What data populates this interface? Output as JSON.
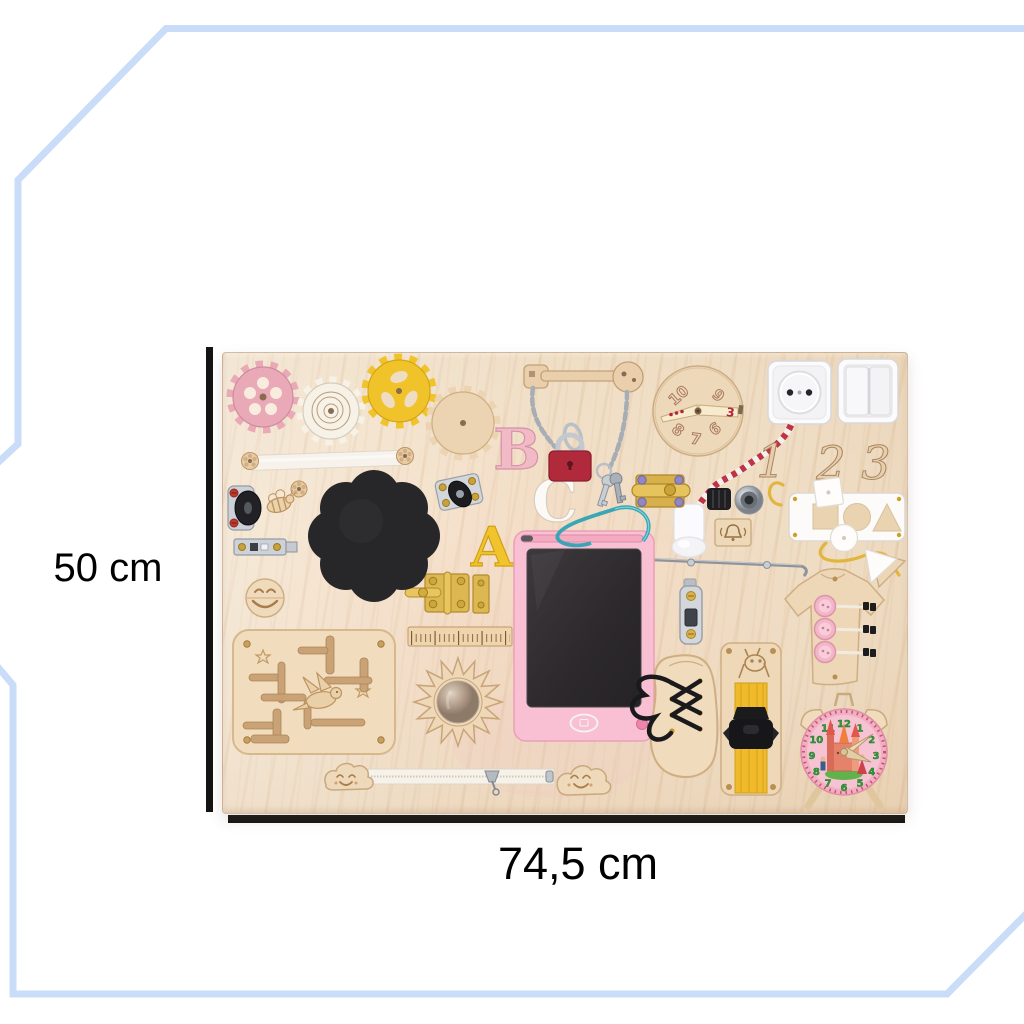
{
  "dimensions": {
    "height_label": "50 cm",
    "width_label": "74,5 cm"
  },
  "letters": {
    "b": "B",
    "c": "C",
    "a": "A"
  },
  "cutout_numbers": {
    "one": "1",
    "two": "2",
    "three": "3"
  },
  "spinner": {
    "labels": [
      "10",
      "9",
      "8",
      "7",
      "6"
    ],
    "pointer_value": "3"
  },
  "clock": {
    "numbers": [
      "12",
      "1",
      "2",
      "3",
      "4",
      "5",
      "6",
      "7",
      "8",
      "9",
      "10",
      "11"
    ]
  },
  "colors": {
    "frame_accent": "#c9dcf8",
    "dimension_line": "#141414",
    "board_wood": "#eedcc3",
    "gear_pink": "#e9a9b6",
    "gear_yellow": "#f1c32b",
    "padlock_red": "#b12a3c",
    "tablet_pink": "#f8c0d2",
    "screen_black": "#312e31",
    "clock_face_pink": "#f2aec2",
    "clock_number_green": "#2f9e38",
    "strap_yellow": "#f1ba2a",
    "cord_red": "#bf3345",
    "lace_black": "#1a1a1c"
  },
  "board_items": [
    "pink-gear",
    "spiral-gear",
    "yellow-gear",
    "wooden-gear",
    "ribbon-with-flower-buttons",
    "caster-wheel",
    "swivel-caster",
    "wooden-bee",
    "slide-latch",
    "black-flower-chalkboard",
    "letter-B",
    "letter-C",
    "letter-A",
    "wooden-key-with-chain",
    "red-padlock",
    "keys-on-ring",
    "number-spinner-dial",
    "power-socket",
    "light-switch",
    "striped-cord",
    "spinning-light",
    "push-light",
    "doorbell-plate",
    "brass-barrel-bolt",
    "wooden-numbers",
    "shape-sorter-with-laces",
    "white-triangle",
    "hook-latch",
    "tshirt-buttoning-board",
    "smiley-disc",
    "brass-hinge",
    "wooden-ruler",
    "sun-mirror",
    "maze-with-dragon",
    "lcd-writing-tablet",
    "stylus",
    "door-lock-plate",
    "lacing-shoe",
    "buckle-strap-with-giraffe",
    "zipper-with-clouds",
    "alarm-clock-face"
  ]
}
